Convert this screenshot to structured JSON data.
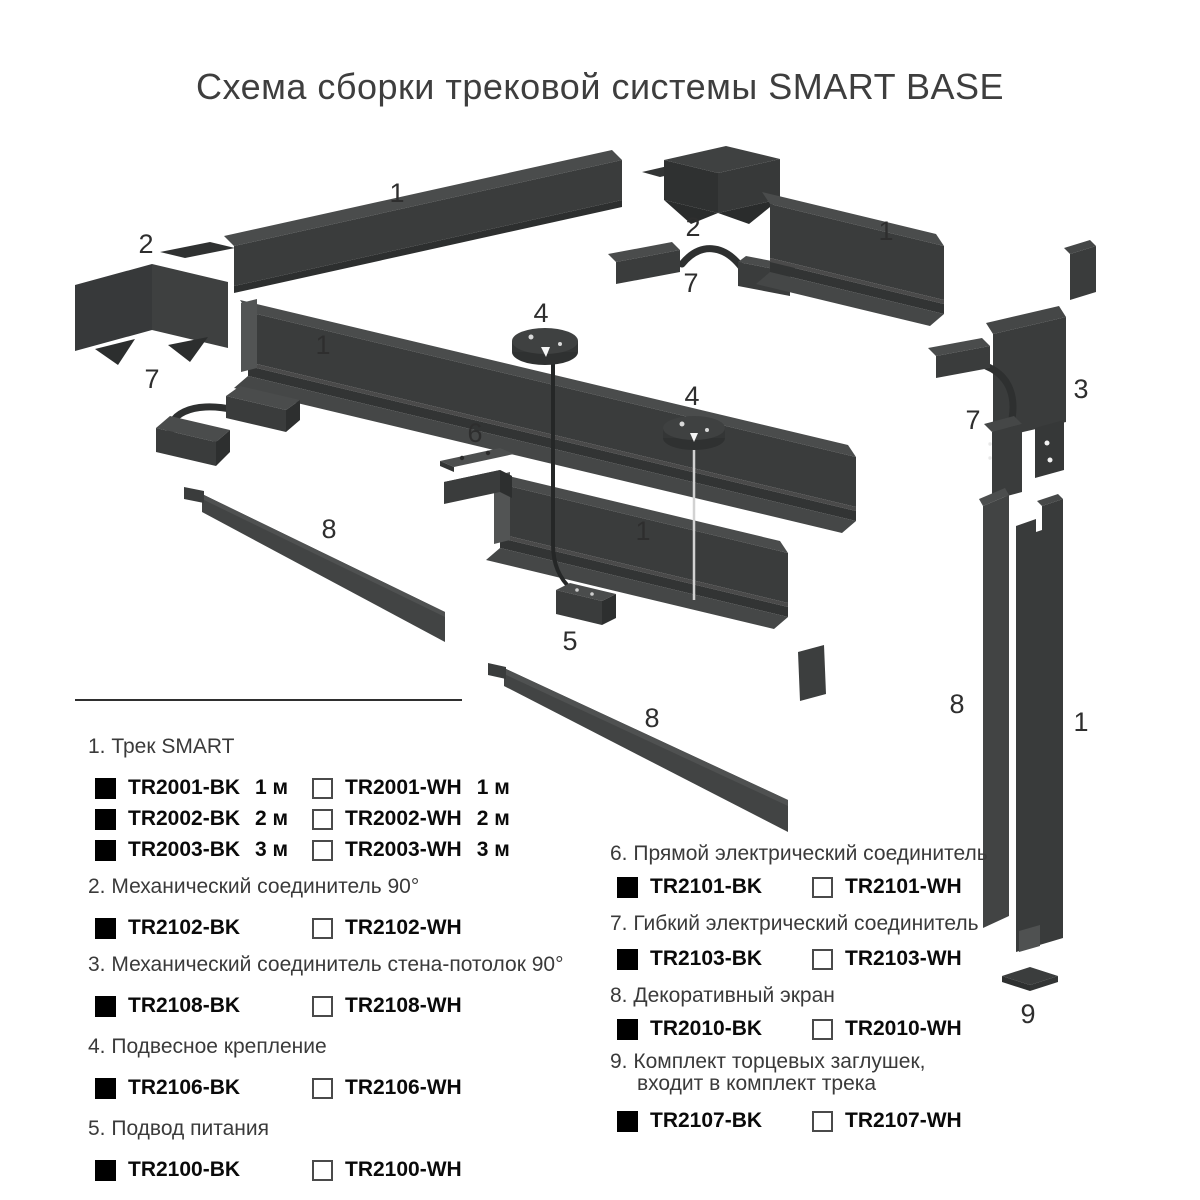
{
  "title": "Схема сборки трековой системы SMART BASE",
  "diagram": {
    "callouts": {
      "n1": "1",
      "n2": "2",
      "n3": "3",
      "n4": "4",
      "n5": "5",
      "n6": "6",
      "n7": "7",
      "n8": "8",
      "n9": "9"
    }
  },
  "colors": {
    "part_front": "#3a3c3c",
    "part_top": "#4a4c4c",
    "part_dark": "#2d2f2f",
    "checkbox_black": "#000000",
    "checkbox_white": "#ffffff",
    "text": "#333333"
  },
  "legend": {
    "sections": [
      {
        "header": "1. Трек SMART",
        "rows": [
          {
            "bk": "TR2001-BK",
            "bk_size": "1 м",
            "wh": "TR2001-WH",
            "wh_size": "1 м"
          },
          {
            "bk": "TR2002-BK",
            "bk_size": "2 м",
            "wh": "TR2002-WH",
            "wh_size": "2 м"
          },
          {
            "bk": "TR2003-BK",
            "bk_size": "3 м",
            "wh": "TR2003-WH",
            "wh_size": "3 м"
          }
        ]
      },
      {
        "header": "2. Механический соединитель 90°",
        "rows": [
          {
            "bk": "TR2102-BK",
            "wh": "TR2102-WH"
          }
        ]
      },
      {
        "header": "3. Механический соединитель стена-потолок 90°",
        "rows": [
          {
            "bk": "TR2108-BK",
            "wh": "TR2108-WH"
          }
        ]
      },
      {
        "header": "4. Подвесное крепление",
        "rows": [
          {
            "bk": "TR2106-BK",
            "wh": "TR2106-WH"
          }
        ]
      },
      {
        "header": "5. Подвод питания",
        "rows": [
          {
            "bk": "TR2100-BK",
            "wh": "TR2100-WH"
          }
        ]
      },
      {
        "header": "6. Прямой электрический соединитель",
        "rows": [
          {
            "bk": "TR2101-BK",
            "wh": "TR2101-WH"
          }
        ]
      },
      {
        "header": "7. Гибкий электрический соединитель",
        "rows": [
          {
            "bk": "TR2103-BK",
            "wh": "TR2103-WH"
          }
        ]
      },
      {
        "header": "8. Декоративный экран",
        "rows": [
          {
            "bk": "TR2010-BK",
            "wh": "TR2010-WH"
          }
        ]
      },
      {
        "header": "9. Комплект торцевых заглушек,",
        "header_line2": "входит в комплект трека",
        "rows": [
          {
            "bk": "TR2107-BK",
            "wh": "TR2107-WH"
          }
        ]
      }
    ]
  }
}
